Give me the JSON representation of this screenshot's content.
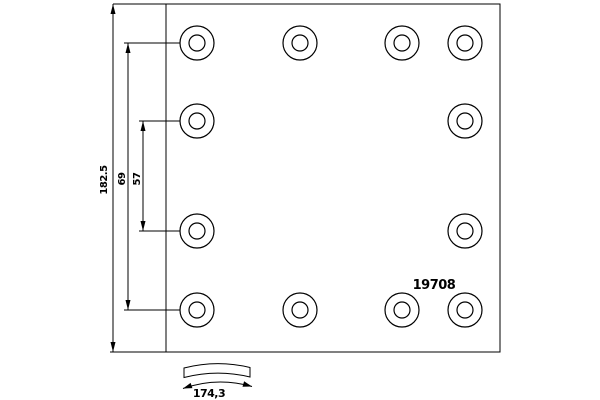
{
  "part_number": "19708",
  "labels": {
    "dim_total": "182.5",
    "dim_outer": "69",
    "dim_inner": "57",
    "dim_arc": "174,3"
  },
  "colors": {
    "line": "#000000",
    "background": "#ffffff"
  },
  "geometry": {
    "plate": {
      "x": 166,
      "y": 4,
      "width": 334,
      "height": 348
    },
    "hole_outer_radius": 17,
    "hole_inner_radius": 8,
    "hole_columns": [
      197,
      300,
      402,
      465
    ],
    "hole_rows": [
      43,
      121,
      231,
      310
    ],
    "holes": [
      [
        0,
        0
      ],
      [
        1,
        0
      ],
      [
        2,
        0
      ],
      [
        3,
        0
      ],
      [
        0,
        1
      ],
      [
        3,
        1
      ],
      [
        0,
        2
      ],
      [
        3,
        2
      ],
      [
        0,
        3
      ],
      [
        1,
        3
      ],
      [
        2,
        3
      ],
      [
        3,
        3
      ]
    ],
    "dim_lines": [
      {
        "name": "total-length",
        "x": 113,
        "y1": 4,
        "y2": 352,
        "ext": [
          {
            "y": 4,
            "x1": 113,
            "x2": 166
          },
          {
            "y": 352,
            "x1": 110,
            "x2": 166
          }
        ]
      },
      {
        "name": "outer-hole-span",
        "x": 128,
        "y1": 43,
        "y2": 310,
        "ext": [
          {
            "y": 43,
            "x1": 124,
            "x2": 181
          },
          {
            "y": 310,
            "x1": 124,
            "x2": 181
          }
        ]
      },
      {
        "name": "inner-hole-span",
        "x": 143,
        "y1": 121,
        "y2": 231,
        "ext": [
          {
            "y": 121,
            "x1": 139,
            "x2": 181
          },
          {
            "y": 231,
            "x1": 139,
            "x2": 181
          }
        ]
      }
    ]
  }
}
